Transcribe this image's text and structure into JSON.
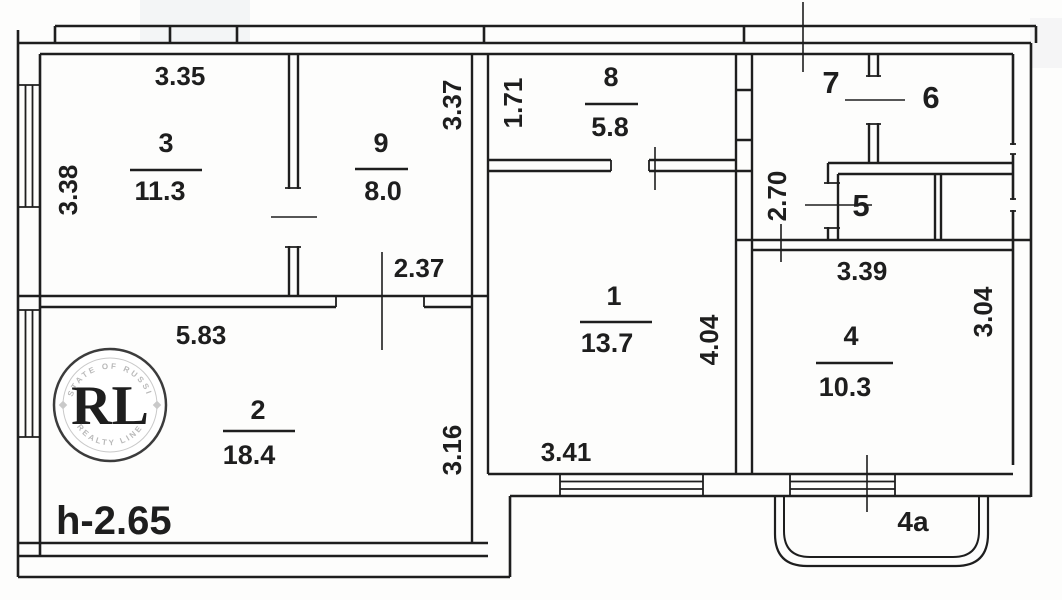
{
  "plan_title": "apartment-floor-plan",
  "labels": {
    "room3_width": "3.35",
    "room3_number": "3",
    "room3_area": "11.3",
    "room3_depth": "3.38",
    "room9_number": "9",
    "room9_area": "8.0",
    "room9_depth": "3.37",
    "hall8_width": "1.71",
    "room8_number": "8",
    "room8_area": "5.8",
    "room7_number": "7",
    "room6_number": "6",
    "room5_number": "5",
    "hall_width": "2.70",
    "door_width": "2.37",
    "room1_number": "1",
    "room1_area": "13.7",
    "room1_depth": "4.04",
    "room1_width": "3.41",
    "room2_width": "5.83",
    "room2_number": "2",
    "room2_area": "18.4",
    "room2_depth": "3.16",
    "ceiling_height": "h-2.65",
    "room4_width": "3.39",
    "room4_number": "4",
    "room4_area": "10.3",
    "room4_depth": "3.04",
    "balcony_label": "4a"
  },
  "logo": {
    "monogram": "RL",
    "arc_top": "ESTATE OF RUSSIA",
    "arc_bottom": "REALTY LINE",
    "gold_color": "#c9a13b"
  },
  "ink_color": "#1e1e1e"
}
